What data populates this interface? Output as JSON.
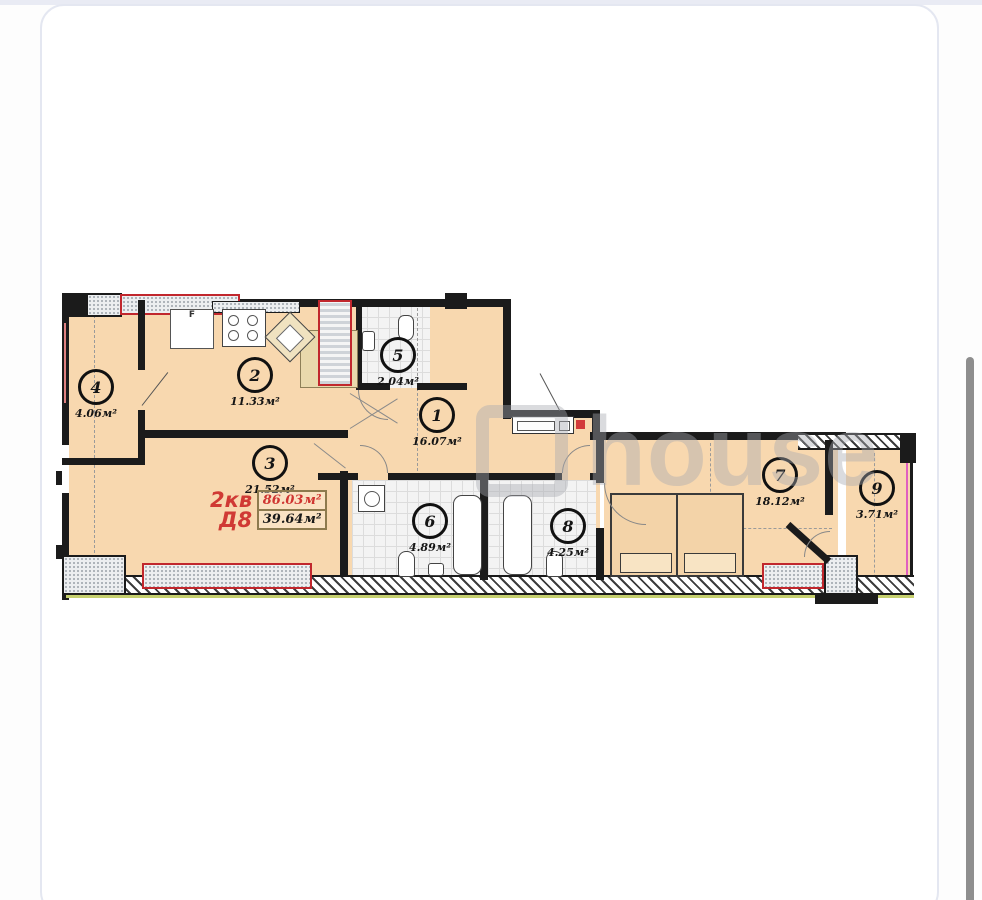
{
  "page": {
    "watermark": "house"
  },
  "plan": {
    "apartment": {
      "type_label": "2кв",
      "block_label": "Д8",
      "total_area": "86.03м²",
      "living_area": "39.64м²"
    },
    "rooms": [
      {
        "num": "1",
        "area": "16.07м²"
      },
      {
        "num": "2",
        "area": "11.33м²"
      },
      {
        "num": "3",
        "area": "21.52м²"
      },
      {
        "num": "4",
        "area": "4.06м²"
      },
      {
        "num": "5",
        "area": "2.04м²"
      },
      {
        "num": "6",
        "area": "4.89м²"
      },
      {
        "num": "7",
        "area": "18.12м²"
      },
      {
        "num": "8",
        "area": "4.25м²"
      },
      {
        "num": "9",
        "area": "3.71м²"
      }
    ],
    "fridge_label": "F",
    "colors": {
      "room_fill": "#f8d8af",
      "wall": "#1b1b1b",
      "highlight_red": "#c1272d",
      "label_red": "#d03a34",
      "balcony_glazing": "#e060c0",
      "accent_green": "#c6d06e"
    }
  }
}
